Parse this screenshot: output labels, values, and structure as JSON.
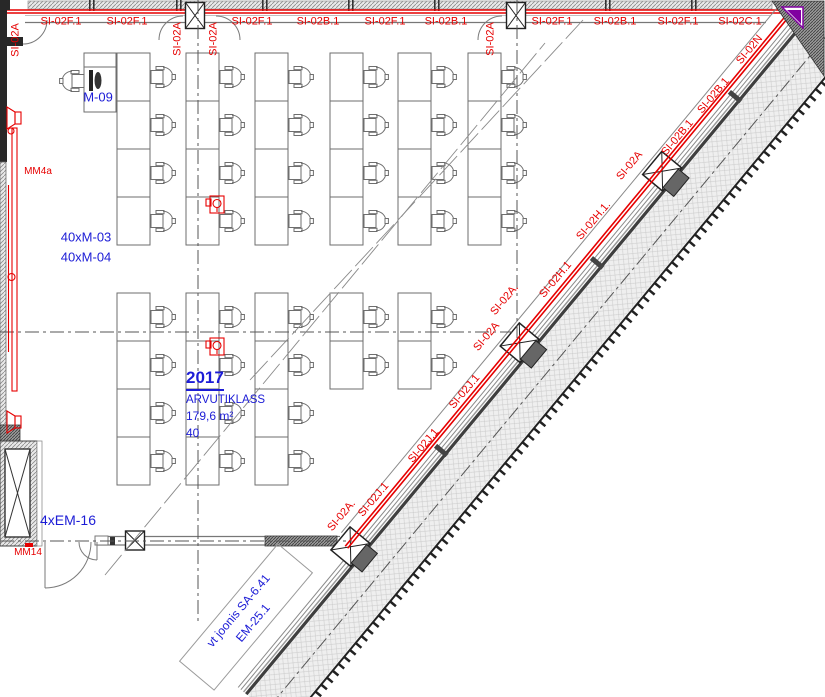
{
  "drawing": {
    "room": {
      "number": "2017",
      "name": "ARVUTIKLASS",
      "area": "179,6 m²",
      "capacity": "40"
    },
    "annotations": {
      "teacher_station": "M-09",
      "monitors_1": "40xM-03",
      "monitors_2": "40xM-04",
      "sockets": "4xEM-16",
      "cable_tray_left": "MM4a",
      "cable_tray_bottom": "MM14",
      "note_line1": "vt joonis SA-6.41",
      "note_line2": "EM-25.1"
    },
    "top_labels": [
      {
        "t": "SI-02F.1",
        "x": 61
      },
      {
        "t": "SI-02F.1",
        "x": 127
      },
      {
        "t": "SI-02F.1",
        "x": 252
      },
      {
        "t": "SI-02B.1",
        "x": 318
      },
      {
        "t": "SI-02F.1",
        "x": 385
      },
      {
        "t": "SI-02B.1",
        "x": 446
      },
      {
        "t": "SI-02F.1",
        "x": 552
      },
      {
        "t": "SI-02B.1",
        "x": 615
      },
      {
        "t": "SI-02F.1",
        "x": 678
      },
      {
        "t": "SI-02C.1",
        "x": 740
      }
    ],
    "vertical_labels": [
      {
        "t": "SI-02A",
        "x": 16,
        "y": 40
      },
      {
        "t": "SI-02A",
        "x": 178,
        "y": 39
      },
      {
        "t": "SI-02A",
        "x": 214,
        "y": 39
      },
      {
        "t": "SI-02A",
        "x": 491,
        "y": 39
      }
    ],
    "diagonal_labels": [
      {
        "t": "SI-02N",
        "x": 750,
        "y": 50
      },
      {
        "t": "SI-02B.1",
        "x": 714,
        "y": 96
      },
      {
        "t": "SI-02B.1",
        "x": 678,
        "y": 138
      },
      {
        "t": "SI-02A",
        "x": 630,
        "y": 166
      },
      {
        "t": "SI-02H.1.",
        "x": 594,
        "y": 221
      },
      {
        "t": "SI-02H.1",
        "x": 556,
        "y": 280
      },
      {
        "t": "SI-02A.",
        "x": 505,
        "y": 300
      },
      {
        "t": "SI-02A",
        "x": 487,
        "y": 337
      },
      {
        "t": "SI-02J.1",
        "x": 465,
        "y": 392
      },
      {
        "t": "SI-02J.1",
        "x": 424,
        "y": 446
      },
      {
        "t": "SI-02J.1",
        "x": 374,
        "y": 500
      },
      {
        "t": "SI-02A.",
        "x": 342,
        "y": 516
      }
    ],
    "furniture": {
      "seat_total": 40,
      "desk_w": 33,
      "row_h": 48,
      "blocks": [
        {
          "cols": [
            117,
            186,
            255,
            330,
            398,
            468
          ],
          "top": 53,
          "rows": [
            4,
            4,
            4,
            4,
            4,
            4
          ]
        },
        {
          "cols": [
            117,
            186,
            255,
            330,
            398
          ],
          "top": 293,
          "rows": [
            4,
            4,
            4,
            2,
            2
          ]
        }
      ]
    },
    "colors": {
      "wiring_red": "#e60000",
      "annotation_blue": "#1c1cd6",
      "line_gray": "#6e6e6e",
      "wall_dark": "#282828",
      "accent_purple": "#8000a0"
    }
  }
}
